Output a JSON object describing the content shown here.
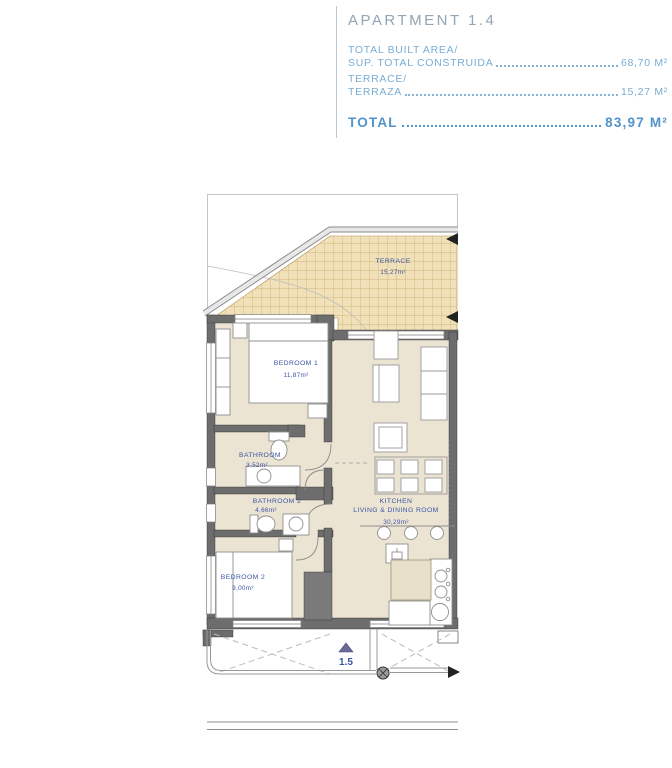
{
  "header": {
    "apartment_title": "APARTMENT 1.4",
    "rows": [
      {
        "label_line1": "TOTAL BUILT AREA/",
        "label_line2": "SUP. TOTAL CONSTRUIDA",
        "value": "68,70 M²"
      },
      {
        "label_line1": "TERRACE/",
        "label_line2": "TERRAZA",
        "value": "15,27 M²"
      }
    ],
    "total_label": "TOTAL",
    "total_value": "83,97 M²"
  },
  "plan": {
    "labels": {
      "terrace_name": "TERRACE",
      "terrace_area": "15,27m²",
      "bedroom1_name": "BEDROOM 1",
      "bedroom1_area": "11,87m²",
      "bathroom1_name": "BATHROOM",
      "bathroom1_area": "3,52m²",
      "bathroom2_name": "BATHROOM 2",
      "bathroom2_area": "4,66m²",
      "bedroom2_name": "BEDROOM 2",
      "bedroom2_area": "9,00m²",
      "kitchen_name_line1": "KITCHEN",
      "kitchen_name_line2": "LIVING & DINING ROOM",
      "kitchen_area": "30,29m²",
      "floor_marker": "1.5"
    },
    "colors": {
      "label_blue": "#3c55a5",
      "floor_beige": "#ece4d3",
      "terrace_tan": "#f1e1b8",
      "terrace_grid": "#c9a86d",
      "wall_gray": "#6d6d6d",
      "header_blue": "#7aadd4",
      "total_blue": "#5193cb",
      "title_gray": "#93a4b3"
    }
  }
}
